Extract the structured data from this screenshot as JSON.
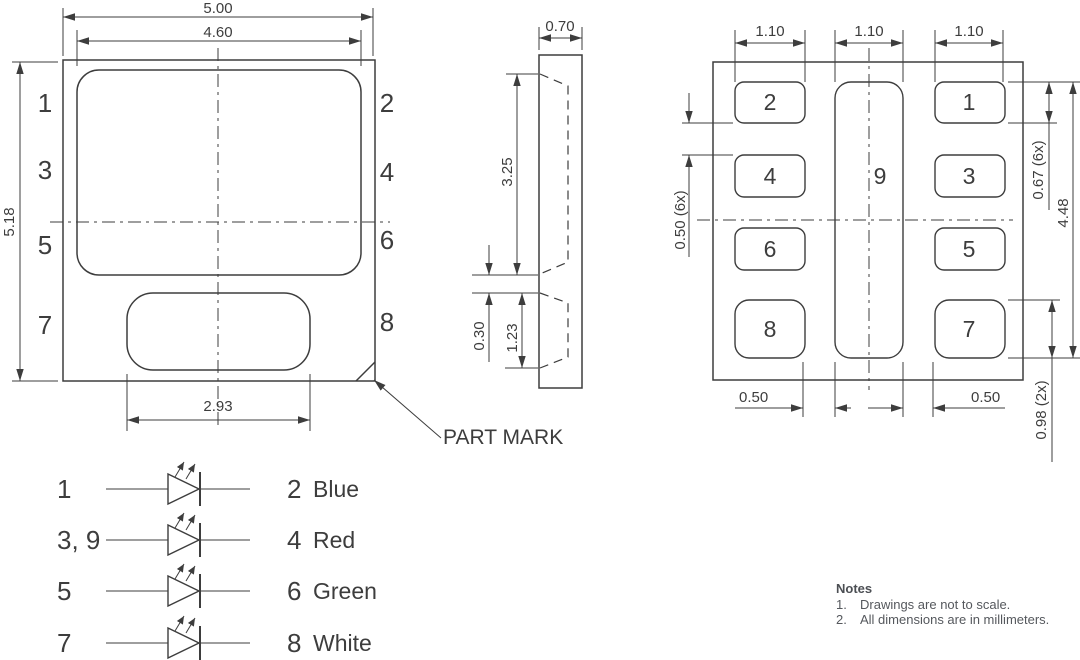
{
  "front_view": {
    "width_outer": "5.00",
    "width_inner": "4.60",
    "height": "5.18",
    "window_width": "2.93",
    "pins_left": [
      "1",
      "3",
      "5",
      "7"
    ],
    "pins_right": [
      "2",
      "4",
      "6",
      "8"
    ],
    "part_mark": "PART MARK"
  },
  "side_view": {
    "width": "0.70",
    "upper_depth": "3.25",
    "gap": "0.30",
    "lower_depth": "1.23"
  },
  "pad_view": {
    "pad_width_dims": [
      "1.10",
      "1.10",
      "1.10"
    ],
    "row_gap": "0.50 (6x)",
    "pad_height": "0.67 (6x)",
    "field_height": "4.48",
    "bottom_gap_left": "0.50",
    "bottom_gap_right": "0.50",
    "bottom_pad_height": "0.98 (2x)",
    "pad_labels": {
      "pad1": "1",
      "pad2": "2",
      "pad3": "3",
      "pad4": "4",
      "pad5": "5",
      "pad6": "6",
      "pad7": "7",
      "pad8": "8",
      "pad9": "9"
    }
  },
  "schematic": {
    "rows": [
      {
        "anode": "1",
        "cathode": "2",
        "color": "Blue"
      },
      {
        "anode": "3, 9",
        "cathode": "4",
        "color": "Red"
      },
      {
        "anode": "5",
        "cathode": "6",
        "color": "Green"
      },
      {
        "anode": "7",
        "cathode": "8",
        "color": "White"
      }
    ]
  },
  "notes": {
    "title": "Notes",
    "items": [
      {
        "num": "1.",
        "text": "Drawings are not to scale."
      },
      {
        "num": "2.",
        "text": "All dimensions are in millimeters."
      }
    ]
  },
  "colors": {
    "line": "#3d3d3d",
    "text": "#3d3d3d",
    "notes_text": "#55585d"
  }
}
